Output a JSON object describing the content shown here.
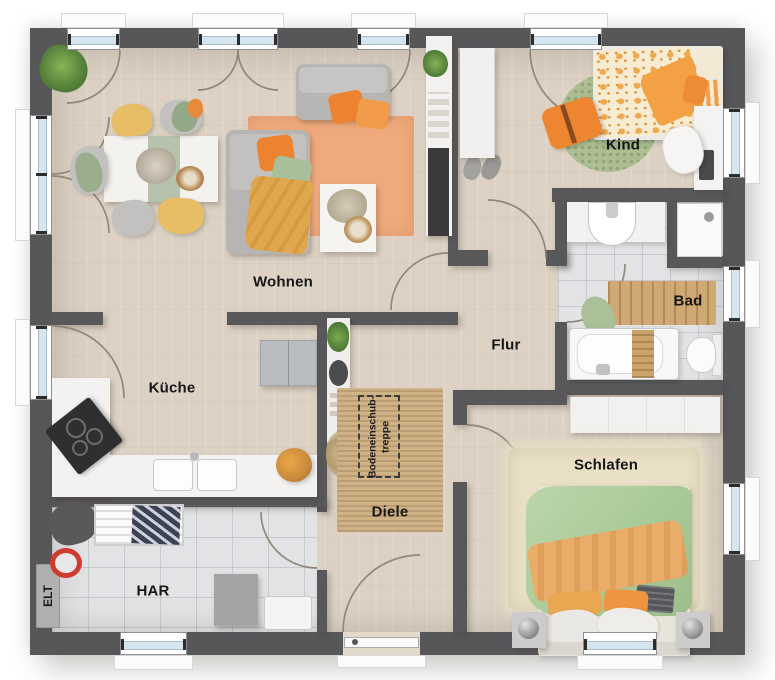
{
  "plan": {
    "title": "floor-plan",
    "rooms": {
      "wohnen": {
        "label": "Wohnen"
      },
      "kueche": {
        "label": "Küche"
      },
      "kind": {
        "label": "Kind"
      },
      "bad": {
        "label": "Bad"
      },
      "flur": {
        "label": "Flur"
      },
      "diele": {
        "label": "Diele"
      },
      "schlafen": {
        "label": "Schlafen"
      },
      "har": {
        "label": "HAR"
      },
      "elt": {
        "label": "ELT"
      },
      "attic_stairs": {
        "label_line1": "Bodeneinschub-",
        "label_line2": "treppe"
      }
    },
    "colors": {
      "wall": "#58585a",
      "floor_wood": "#dcd1c3",
      "floor_tile": "#e2e3e5",
      "rug_orange": "#efa97c",
      "rug_green": "#adbf92",
      "rug_jute": "#cfb286",
      "accent_orange": "#ed8330",
      "accent_green": "#a7c09a",
      "accent_mustard": "#dfa74e",
      "window_glass": "#d5e6f0"
    }
  }
}
